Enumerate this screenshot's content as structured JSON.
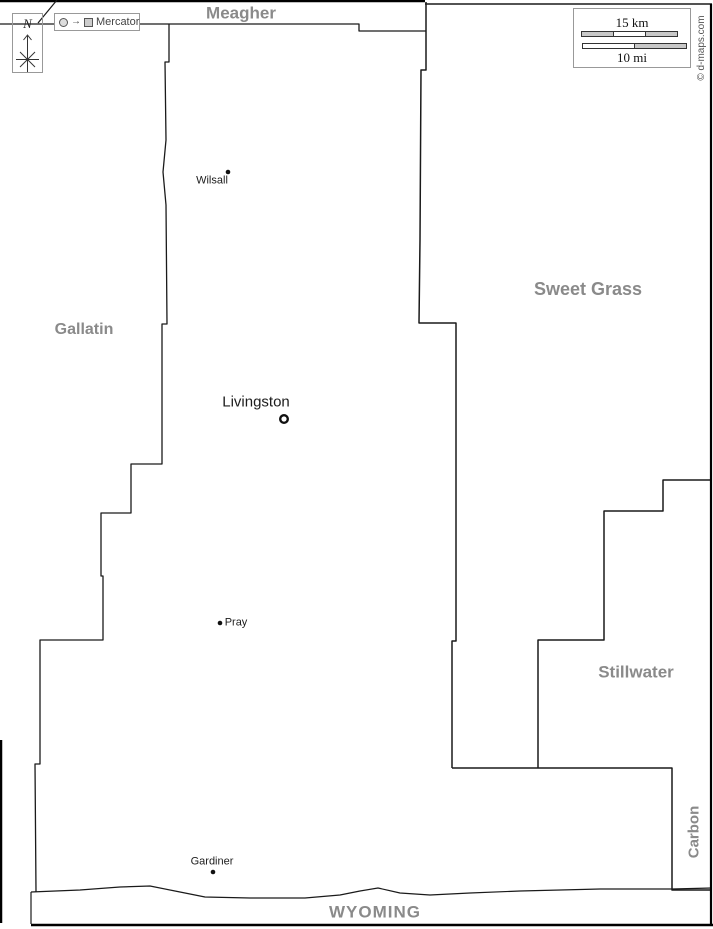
{
  "map": {
    "counties": [
      {
        "name": "Meagher"
      },
      {
        "name": "Gallatin"
      },
      {
        "name": "Sweet Grass"
      },
      {
        "name": "Stillwater"
      },
      {
        "name": "Carbon"
      }
    ],
    "state_label": "WYOMING",
    "cities": [
      {
        "name": "Wilsall",
        "marker": "dot"
      },
      {
        "name": "Livingston",
        "marker": "county-seat-ring"
      },
      {
        "name": "Pray",
        "marker": "dot"
      },
      {
        "name": "Gardiner",
        "marker": "dot"
      }
    ]
  },
  "legend": {
    "north": "N",
    "projection": "Mercator",
    "scale_km": "15 km",
    "scale_mi": "10 mi"
  },
  "credit": "© d-maps.com",
  "colors": {
    "boundary": "#1a1a1a",
    "county_label": "#8a8a8a",
    "city_label": "#1c1c1c",
    "background": "#ffffff"
  }
}
